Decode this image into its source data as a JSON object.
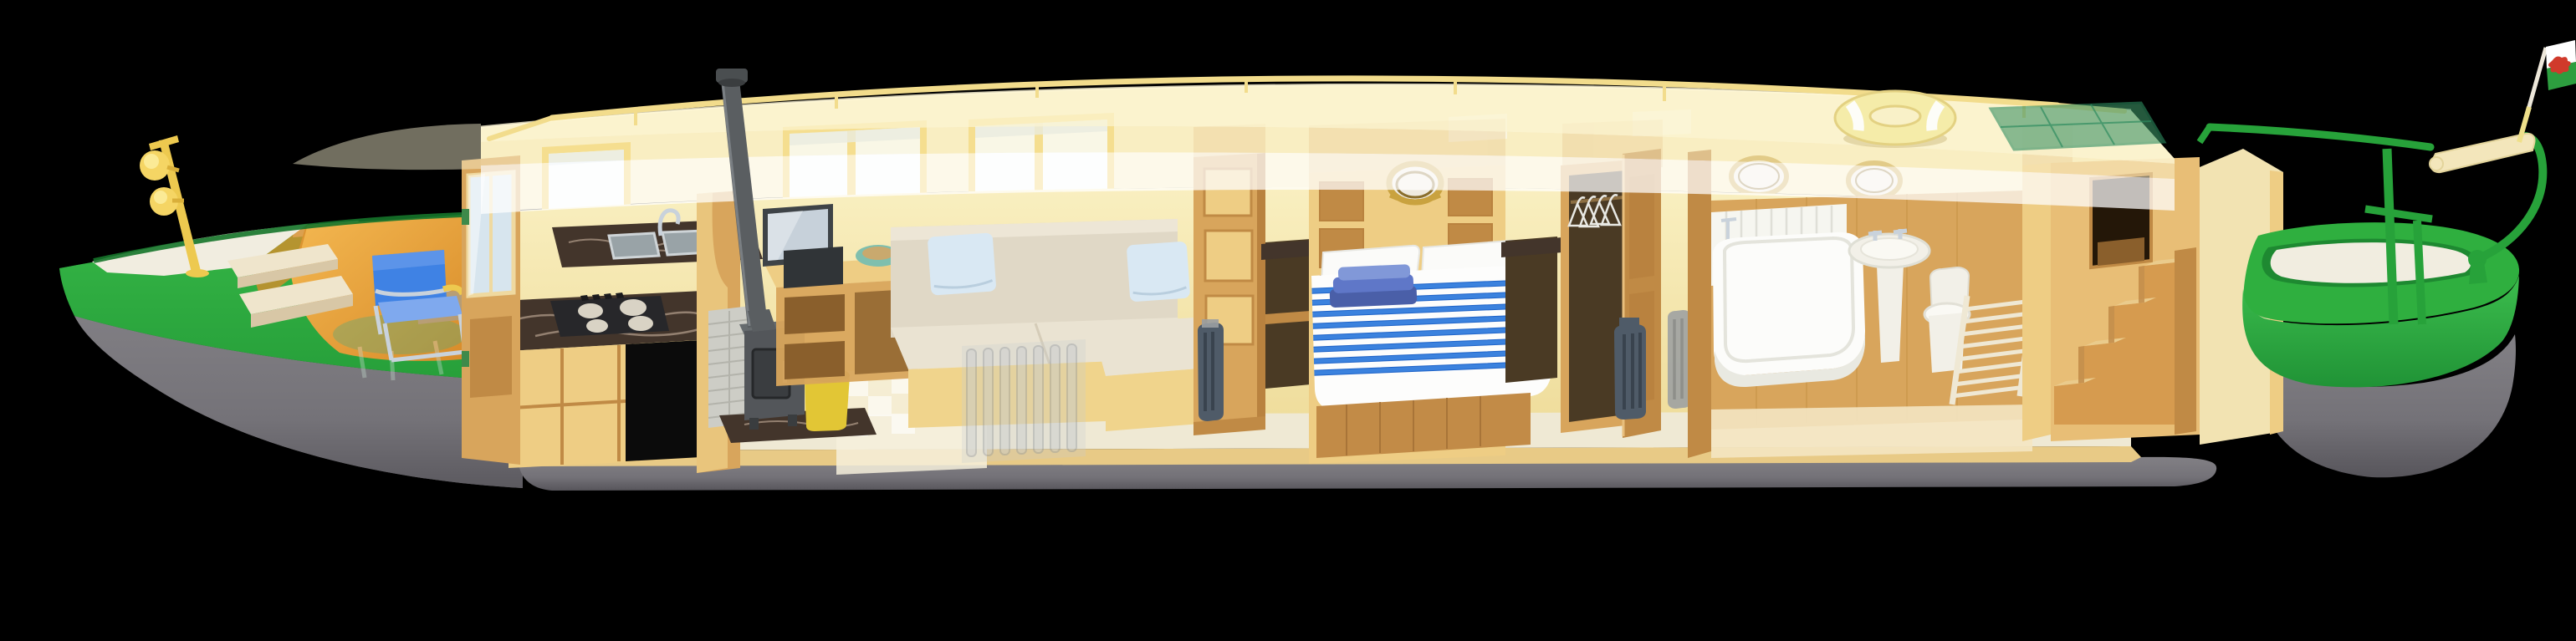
{
  "scene": {
    "background": "#000000",
    "subject": "narrowboat-cutaway-illustration",
    "rooms": [
      "bow well deck",
      "galley",
      "saloon",
      "bedroom",
      "bathroom",
      "stern deck"
    ]
  },
  "palette": {
    "bg": "#000000",
    "hullGray": "#767479",
    "hullGrayDark": "#55535A",
    "hullGreen": "#2FAF3F",
    "hullGreenDark": "#1F8F33",
    "bulwarkGreenDeep": "#15742A",
    "deckWhite": "#F1EDE0",
    "wellDeckOrange": "#F0AC42",
    "wellDeckOrangeDark": "#D68C2B",
    "benchCream": "#EFE5CC",
    "benchCreamDark": "#D8C7A6",
    "poleYellow": "#EDC94F",
    "lampYellow": "#F5D564",
    "lampGlow": "#FBEA96",
    "chairBlue": "#3F82E4",
    "chairBlueLight": "#7FA9EE",
    "chromeGray": "#C9D2DB",
    "ghostGreen": "#5FA877",
    "ghostBlue": "#7FA9D8",
    "cabinCream": "#F7E8B2",
    "roofHaze": "#FBF4D2",
    "cutWhite": "#FFFFFF",
    "railYellow": "#F2DC8C",
    "windowFrame": "#EFC94C",
    "glassWhite": "#F7FAFA",
    "glassSky": "#D7E5EE",
    "woodLight": "#EECD84",
    "woodMid": "#D8A55C",
    "woodMidDark": "#C08A45",
    "woodDark": "#B9823F",
    "woodDeep": "#8A5F2C",
    "wallCreamInner": "#F8EDB9",
    "wallCreamLower": "#F0DE9E",
    "marbleDark": "#43352B",
    "marbleVein": "#C9B39E",
    "steelSink": "#99A3A7",
    "hobBlack": "#27272A",
    "burnerCream": "#D9D3C5",
    "stoveGray": "#53565A",
    "stoveGrayDark": "#3A3D40",
    "chimneyGray": "#5A5E61",
    "brickGray": "#CDCDC6",
    "logBinYellow": "#E2C635",
    "logTan": "#C89A5E",
    "voidBlack": "#0B0B0B",
    "tvFrame": "#3E4347",
    "tvScreen": "#C7D1DA",
    "mediaBox": "#303437",
    "bowlTeal": "#7FBFAE",
    "bowlInner": "#C9A96E",
    "sofaCream": "#E0D8C6",
    "sofaSeat": "#EAE3D2",
    "sofaBase": "#F0D48C",
    "pillowBlue": "#D9E8F3",
    "radiatorGhost": "#C6CBD0",
    "radiatorDark": "#4F5B68",
    "radiatorMid": "#9A9EA2",
    "duvetWhite": "#FDFDFC",
    "duvetBlue": "#3B82DE",
    "duvetBlueDark": "#1E63C8",
    "towelNavy": "#4A5FA8",
    "towelBlue": "#5F77C8",
    "towelLight": "#8198D8",
    "bedWood": "#C28B47",
    "portholeBrass": "#C9A23F",
    "portholeBrassDark": "#8A6E2C",
    "portholeGlass": "#EFEADF",
    "wardrobeDark": "#4A3A24",
    "hangerWhite": "#E9E9E4",
    "bathWhite": "#FCFCFA",
    "bathShadow": "#E9E9E1",
    "plankWhite": "#F6F6F0",
    "fixtureWhite": "#F2F0E8",
    "towelRailCream": "#EFE8D4",
    "stairsWood": "#D69B4F",
    "stairsTread": "#EACB8C",
    "stairsRiser": "#B97E3C",
    "hatchDark": "#241708",
    "railGreen": "#27A23A",
    "tillerCream": "#F3E6BB",
    "flagPoleCream": "#EDE7DA",
    "flagWhite": "#FFFFFF",
    "flagGreen": "#2D9E3F",
    "dragonRed": "#D03A2B",
    "lifeRingYellow": "#F5ECA9",
    "lifeRingBand": "#FDFDF8",
    "solarGreen": "#3E9466",
    "floorCarpet": "#EFE9D4",
    "floorWood": "#E8CA86",
    "rearWallCream": "#F2E3B2"
  }
}
